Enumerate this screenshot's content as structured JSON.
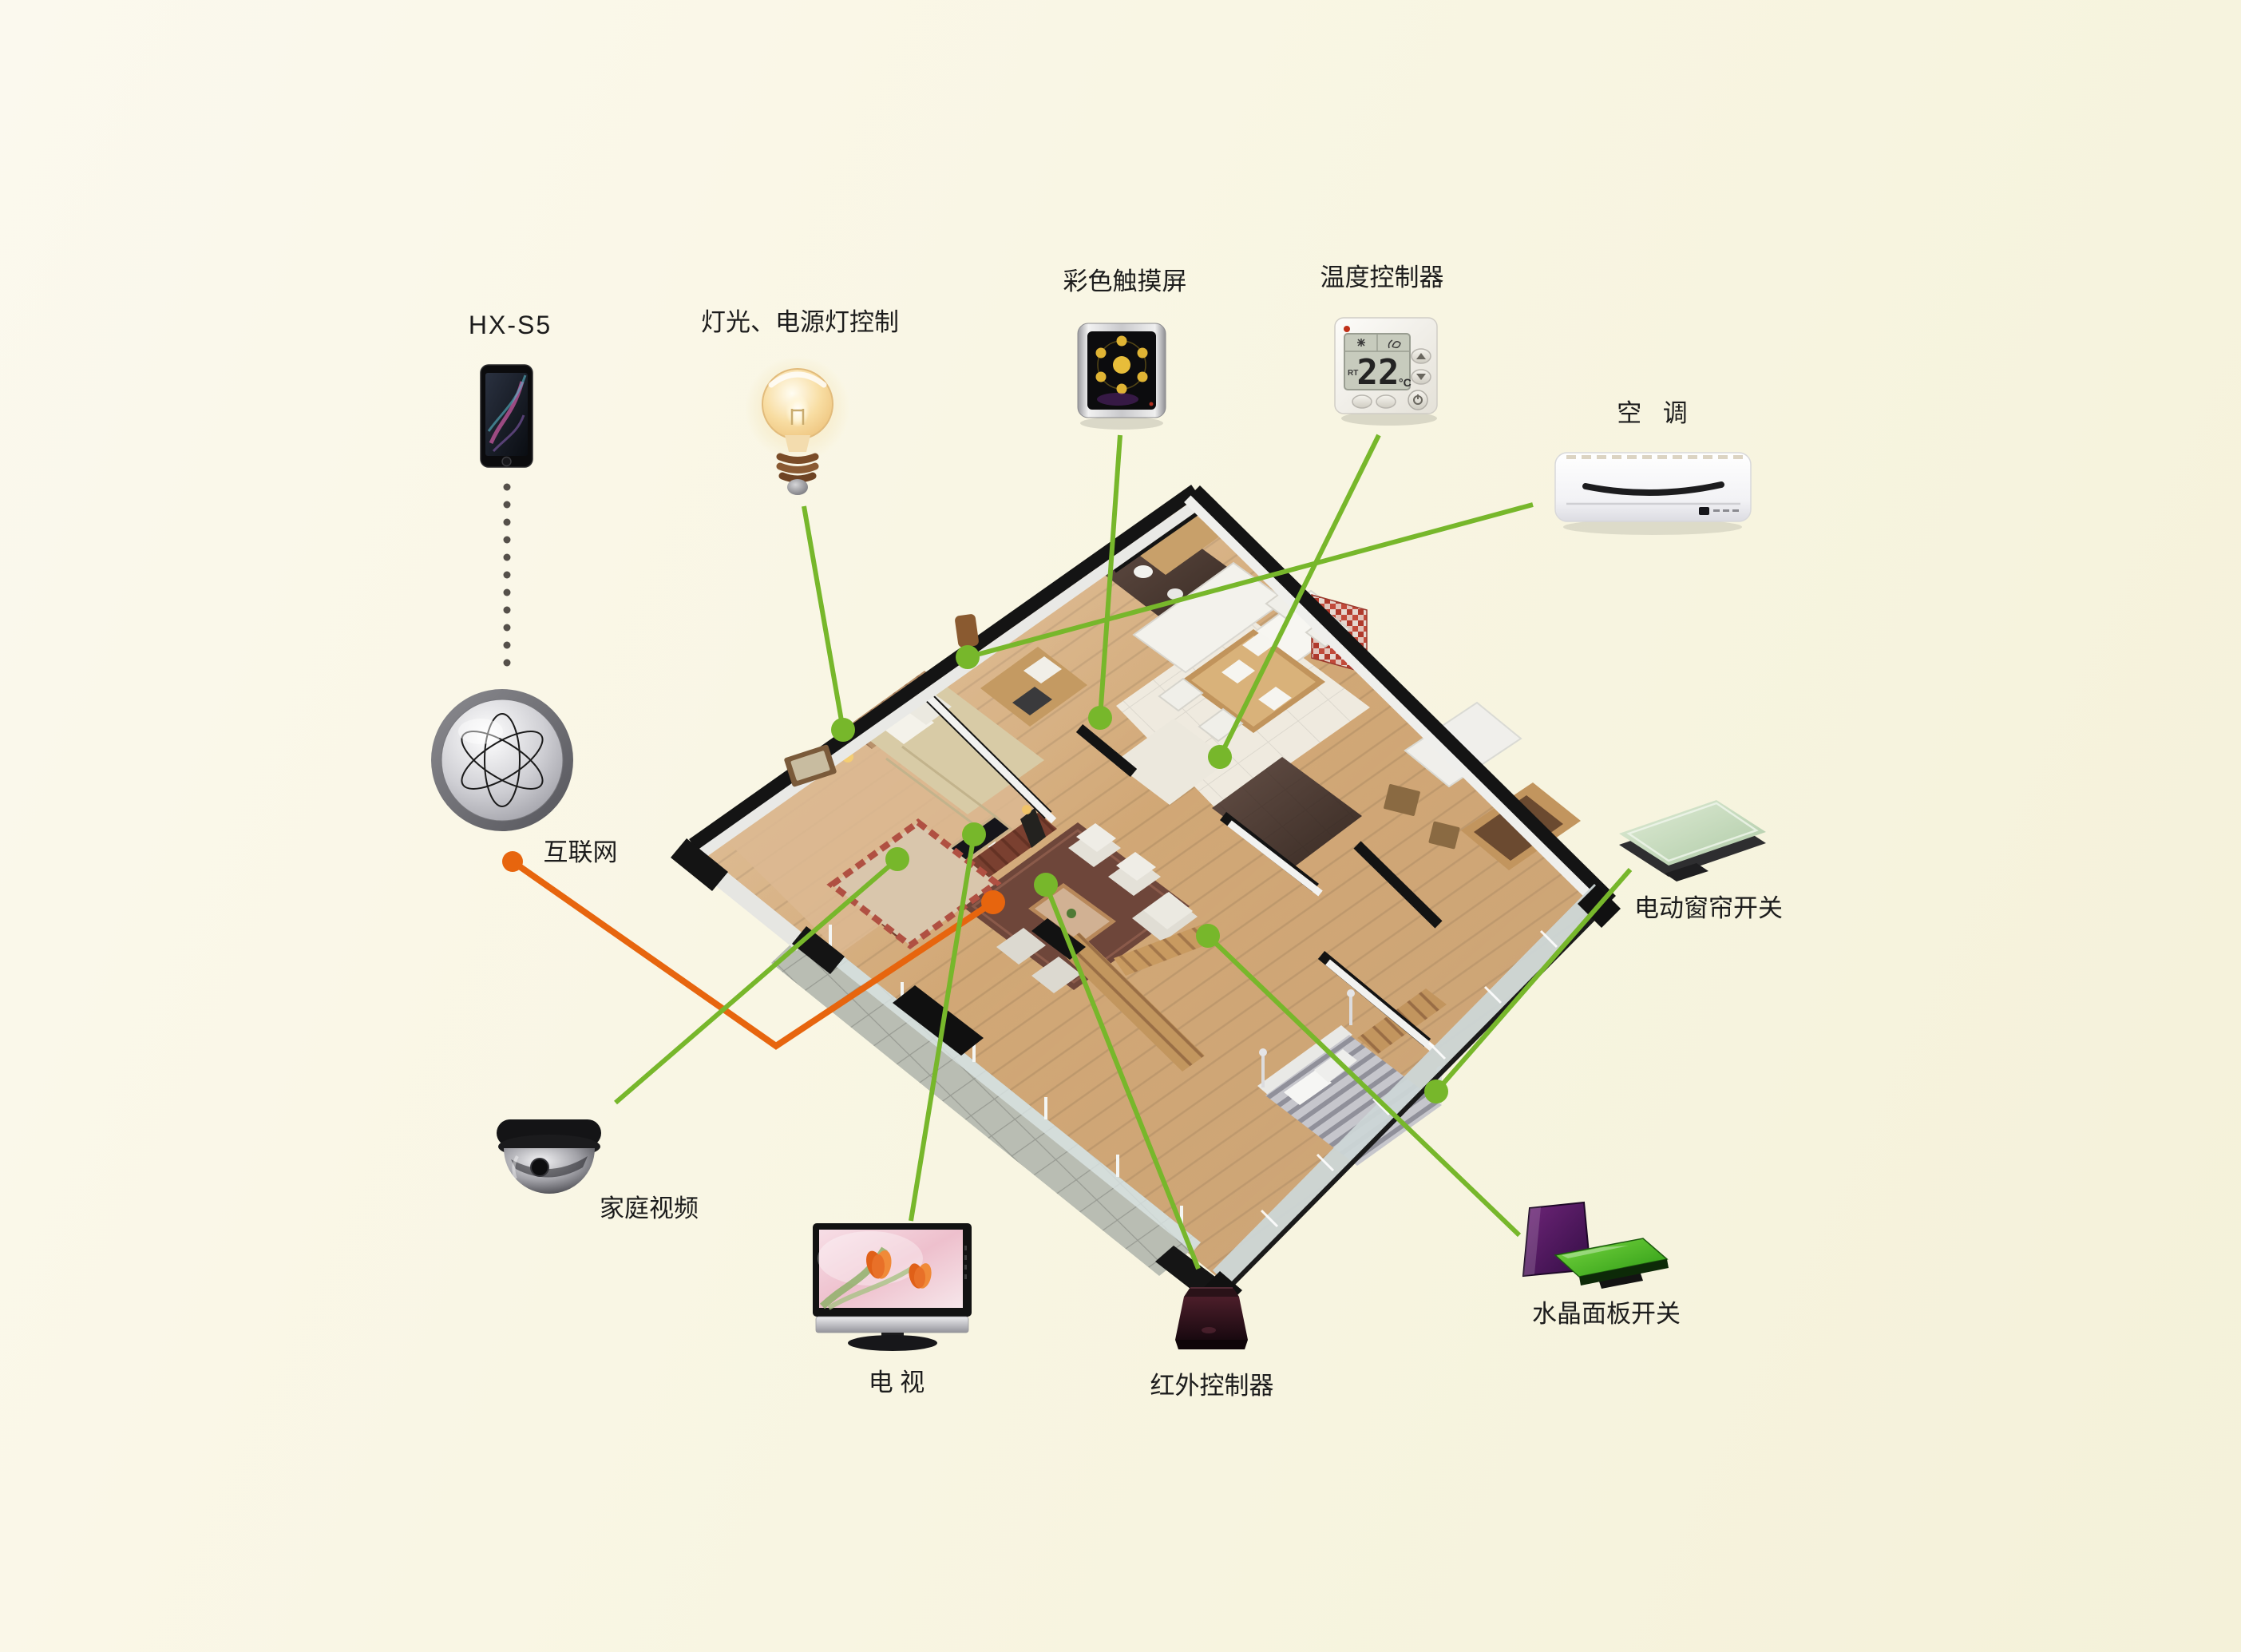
{
  "diagram_title": "smart home control system floorplan diagram",
  "colors": {
    "background": "#f8f5e2",
    "green_line": "#77b72b",
    "orange_line": "#e7650e",
    "label_text": "#1c1c1c"
  },
  "nodes": {
    "phone": {
      "label": "HX-S5"
    },
    "lighting": {
      "label": "灯光、电源灯控制"
    },
    "touchscreen": {
      "label": "彩色触摸屏"
    },
    "thermostat": {
      "label": "温度控制器",
      "display_temp": "22",
      "display_unit": "°C",
      "display_mode": "RT"
    },
    "ac": {
      "label": "空 调"
    },
    "internet": {
      "label": "互联网"
    },
    "camera": {
      "label": "家庭视频"
    },
    "tv": {
      "label": "电 视"
    },
    "ir": {
      "label": "红外控制器"
    },
    "crystal": {
      "label": "水晶面板开关"
    },
    "curtain": {
      "label": "电动窗帘开关"
    }
  },
  "connections": [
    {
      "from": "lighting",
      "to": "master-bedroom-wall",
      "color": "green"
    },
    {
      "from": "touchscreen",
      "to": "entry-hallway",
      "color": "green"
    },
    {
      "from": "thermostat",
      "to": "dining-area-wall",
      "color": "green"
    },
    {
      "from": "ac",
      "to": "upper-hallway",
      "color": "green"
    },
    {
      "from": "camera",
      "to": "living-room-wall",
      "color": "green"
    },
    {
      "from": "tv",
      "to": "media-wall",
      "color": "green"
    },
    {
      "from": "ir",
      "to": "living-room-floor",
      "color": "green"
    },
    {
      "from": "crystal",
      "to": "lower-bedroom-wardrobe",
      "color": "green"
    },
    {
      "from": "curtain",
      "to": "right-bedroom-wall",
      "color": "green"
    },
    {
      "from": "internet",
      "to": "living-room",
      "color": "orange"
    },
    {
      "from": "phone",
      "to": "internet",
      "color": "dotted-grey"
    }
  ]
}
